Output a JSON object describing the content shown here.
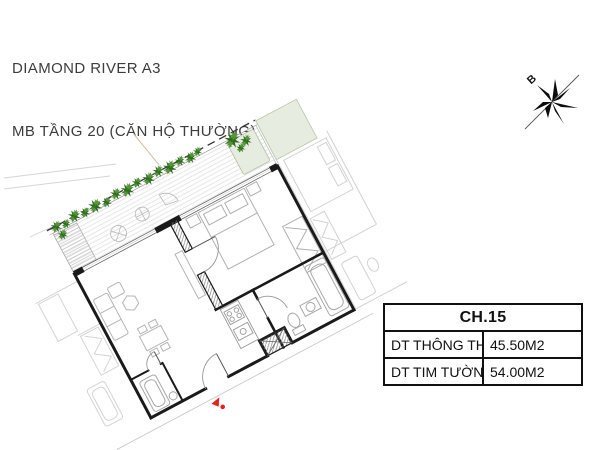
{
  "header": {
    "line1": "DIAMOND RIVER A3",
    "line2": "MB TẦNG 20 (CĂN HỘ THƯỜNG)"
  },
  "compass": {
    "label": "B"
  },
  "area_table": {
    "header": "CH.15",
    "rows": [
      {
        "label": "DT THÔNG THỦY",
        "value": "45.50M2"
      },
      {
        "label": "DT TIM TƯỜNG",
        "value": "54.00M2"
      }
    ]
  },
  "floor_plan": {
    "unit": "CH.15",
    "rotation_deg": -28,
    "colors": {
      "wall": "#1a1a1a",
      "furniture": "#b9b9b9",
      "neighbor": "#d2d2d2",
      "plant_dark": "#2d6a1c",
      "plant_light": "#55963a",
      "planter_fill": "#e7ece0",
      "entry_marker": "#e42320",
      "deck_line": "#cfcfcf",
      "title_color": "#3d3d3d"
    }
  }
}
